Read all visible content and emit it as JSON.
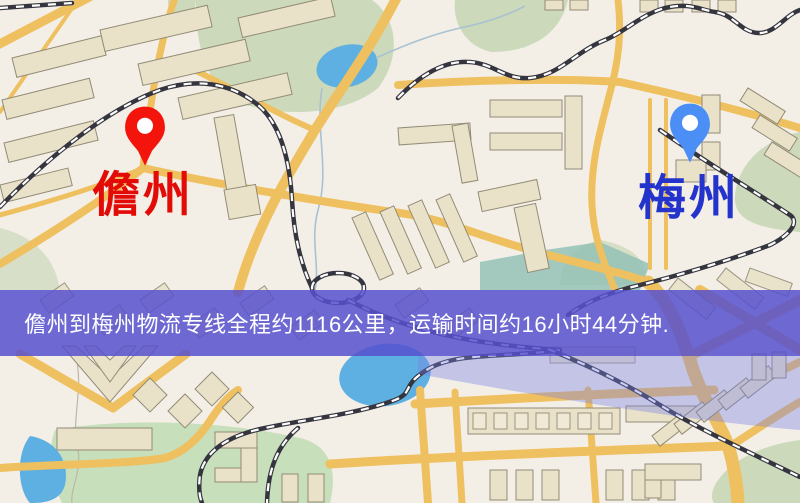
{
  "banner": {
    "text": "儋州到梅州物流专线全程约1116公里，运输时间约16小时44分钟.",
    "distance_km": "1116",
    "duration": "16小时44分钟",
    "background_color": "#5650ce",
    "text_color": "#ffffff"
  },
  "markers": {
    "origin": {
      "label": "儋州",
      "pin_color": "#f3140c",
      "label_color": "#e30b07"
    },
    "destination": {
      "label": "梅州",
      "pin_color": "#4a8ef6",
      "label_color": "#2433cc"
    }
  },
  "map": {
    "background_color": "#f3efe7",
    "road_color": "#efc05f",
    "park_color": "#ccd9ba",
    "water_color": "#5fb0e2"
  }
}
